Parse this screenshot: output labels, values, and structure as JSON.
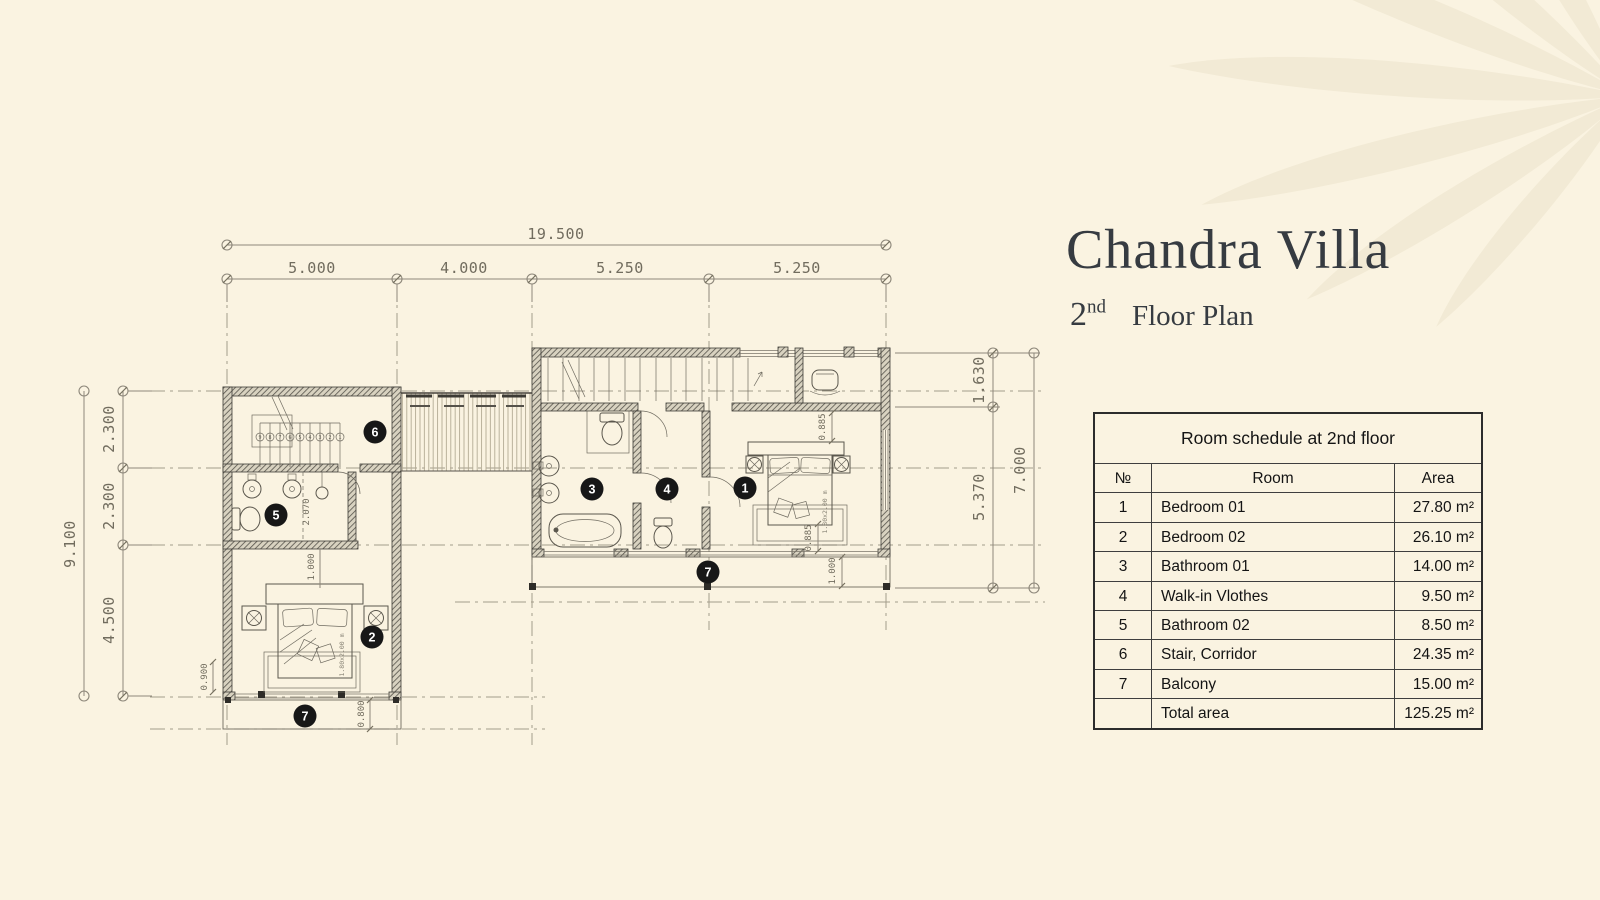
{
  "page": {
    "background_color": "#faf3e1",
    "ink_color": "#363b41",
    "watermark_color": "#f1e9d3"
  },
  "title": {
    "name": "Chandra Villa",
    "floor_num": "2",
    "floor_sup": "nd",
    "floor_label": "Floor Plan"
  },
  "schedule": {
    "title": "Room schedule at 2nd floor",
    "headers": {
      "no": "№",
      "room": "Room",
      "area": "Area"
    },
    "rows": [
      {
        "no": "1",
        "room": "Bedroom 01",
        "area": "27.80 m²"
      },
      {
        "no": "2",
        "room": "Bedroom 02",
        "area": "26.10 m²"
      },
      {
        "no": "3",
        "room": "Bathroom 01",
        "area": "14.00 m²"
      },
      {
        "no": "4",
        "room": "Walk-in Vlothes",
        "area": "9.50 m²"
      },
      {
        "no": "5",
        "room": "Bathroom 02",
        "area": "8.50 m²"
      },
      {
        "no": "6",
        "room": "Stair, Corridor",
        "area": "24.35 m²"
      },
      {
        "no": "7",
        "room": "Balcony",
        "area": "15.00 m²"
      },
      {
        "no": "",
        "room": "Total area",
        "area": "125.25 m²"
      }
    ]
  },
  "plan": {
    "dims": {
      "overall_width": "19.500",
      "top_segments": [
        "5.000",
        "4.000",
        "5.250",
        "5.250"
      ],
      "overall_height_left": "9.100",
      "left_segments": [
        "2.300",
        "2.300",
        "4.500"
      ],
      "right_segments": [
        "1.630",
        "5.370"
      ],
      "overall_height_right": "7.000",
      "d2070": "2.070",
      "d1000a": "1.000",
      "d0900": "0.900",
      "d0800": "0.800",
      "d0885a": "0.885",
      "d0885b": "0.885",
      "d1000b": "1.000"
    },
    "bed_label": "1.80x2.00 m",
    "stair_numbers": [
      "9",
      "8",
      "7",
      "6",
      "5",
      "4",
      "3",
      "2",
      "1"
    ],
    "markers": {
      "m1": "1",
      "m2": "2",
      "m3": "3",
      "m4": "4",
      "m5": "5",
      "m6": "6",
      "m7a": "7",
      "m7b": "7"
    }
  }
}
